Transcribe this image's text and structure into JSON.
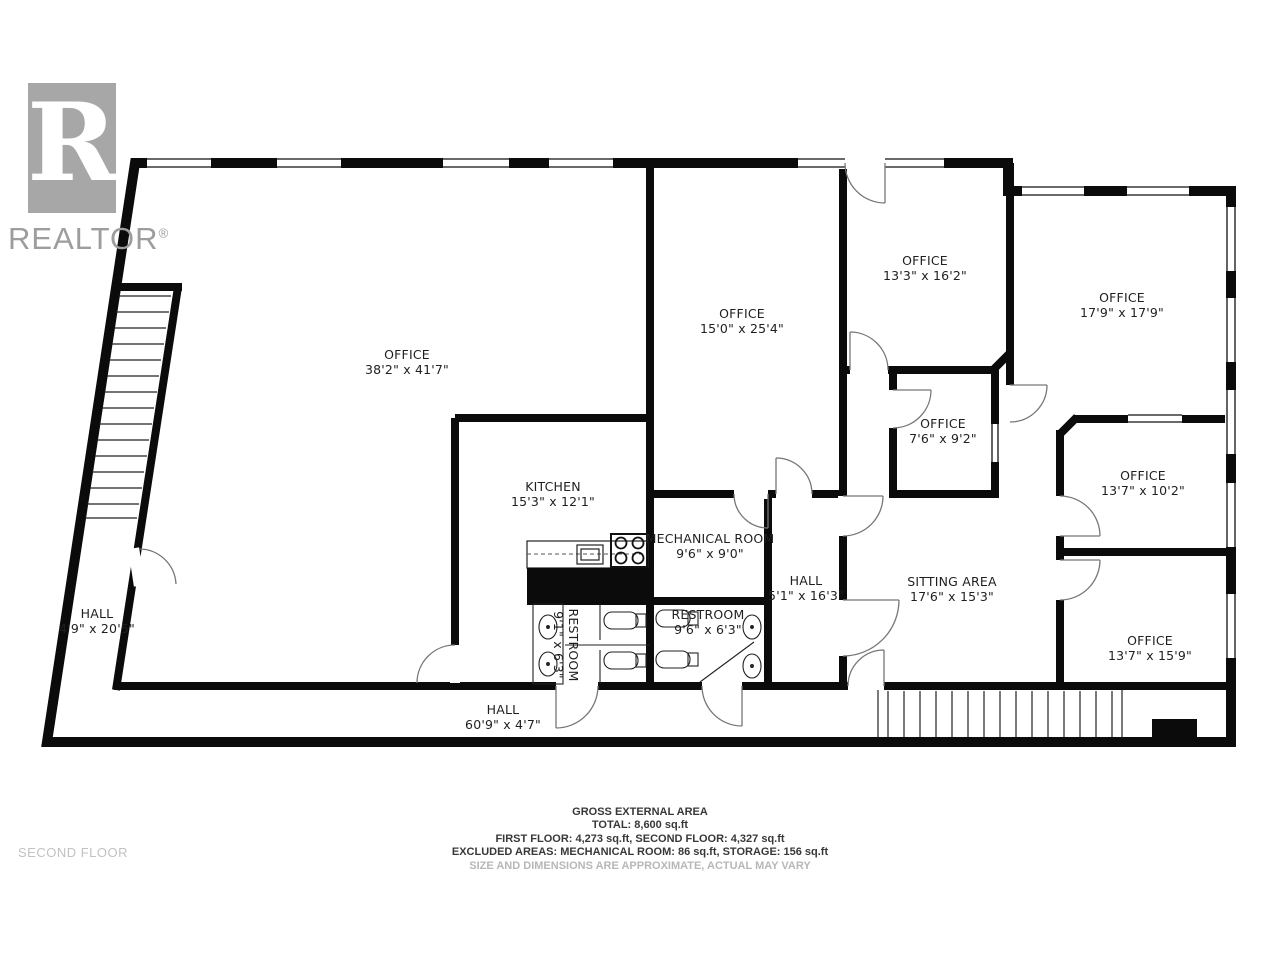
{
  "logo": {
    "letter": "R",
    "brand": "REALTOR",
    "registered": "®"
  },
  "floor_label": "SECOND FLOOR",
  "rooms": [
    {
      "name": "OFFICE",
      "dims": "38'2\" x 41'7\""
    },
    {
      "name": "OFFICE",
      "dims": "15'0\" x 25'4\""
    },
    {
      "name": "OFFICE",
      "dims": "13'3\" x 16'2\""
    },
    {
      "name": "OFFICE",
      "dims": "17'9\" x 17'9\""
    },
    {
      "name": "OFFICE",
      "dims": "7'6\" x 9'2\""
    },
    {
      "name": "OFFICE",
      "dims": "13'7\" x 10'2\""
    },
    {
      "name": "OFFICE",
      "dims": "13'7\" x 15'9\""
    },
    {
      "name": "KITCHEN",
      "dims": "15'3\" x 12'1\""
    },
    {
      "name": "MECHANICAL ROOM",
      "dims": "9'6\" x 9'0\""
    },
    {
      "name": "HALL",
      "dims": "5'1\" x 16'3\""
    },
    {
      "name": "SITTING AREA",
      "dims": "17'6\" x 15'3\""
    },
    {
      "name": "RESTROOM",
      "dims": "9'6\" x 6'3\""
    },
    {
      "name": "RESTROOM",
      "dims": "9'1\" x 6'3\""
    },
    {
      "name": "HALL",
      "dims": "4'9\" x 20'5\""
    },
    {
      "name": "HALL",
      "dims": "60'9\" x 4'7\""
    }
  ],
  "footer": {
    "line1": "GROSS EXTERNAL AREA",
    "line2": "TOTAL: 8,600 sq.ft",
    "line3": "FIRST FLOOR: 4,273 sq.ft, SECOND FLOOR: 4,327 sq.ft",
    "line4": "EXCLUDED AREAS: MECHANICAL ROOM: 86 sq.ft, STORAGE: 156 sq.ft",
    "line5": "SIZE AND DIMENSIONS ARE APPROXIMATE, ACTUAL MAY VARY"
  },
  "colors": {
    "wall": "#0b0b0b",
    "label": "#1f1f1f",
    "muted": "#b7b7b7",
    "logo_gray": "#a7a7a7"
  }
}
